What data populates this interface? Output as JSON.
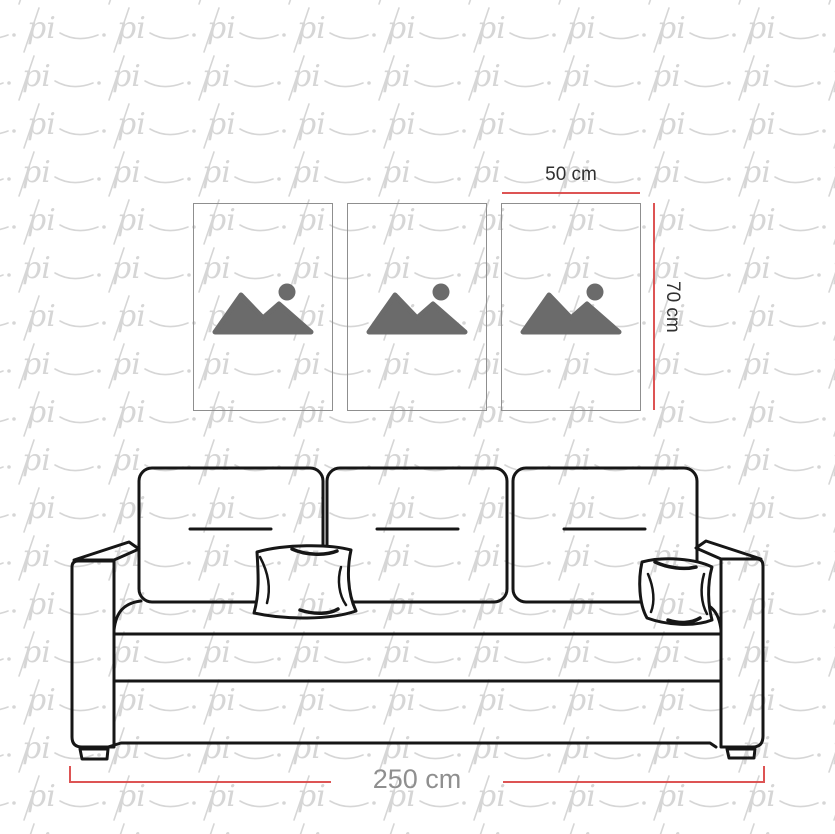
{
  "page": {
    "background": "#ffffff"
  },
  "watermark": {
    "text": "pi",
    "color": "#d6d6d6"
  },
  "dimension_labels": {
    "frame_width": "50 cm",
    "frame_height": "70 cm",
    "sofa_width": "250 cm"
  },
  "frames": {
    "count": 3,
    "icon": "image-placeholder",
    "border_color": "#8f8f8f",
    "icon_color": "#6b6b6b"
  },
  "colors": {
    "dimension_line": "#dd5454",
    "label_dark": "#303030",
    "label_gray": "#8f8f8f",
    "sofa_line": "#161616"
  }
}
